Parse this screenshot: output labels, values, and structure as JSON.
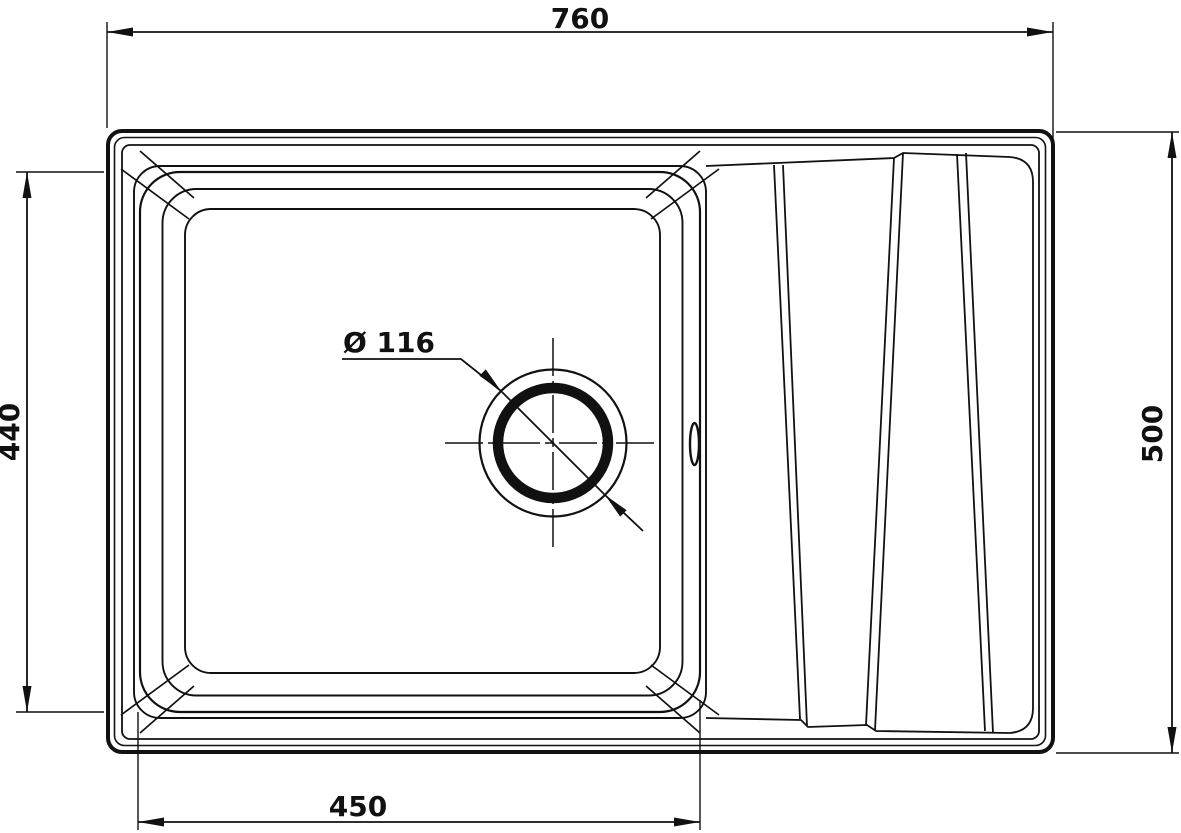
{
  "drawing": {
    "type": "technical-dimension-drawing",
    "subject": "kitchen sink top view - single bowl with drainboard",
    "units": "mm",
    "line_color": "#111111",
    "background_color": "#ffffff",
    "dimensions": {
      "overall_width": {
        "label": "760",
        "value": 760,
        "edge": "top"
      },
      "overall_depth": {
        "label": "500",
        "value": 500,
        "edge": "right"
      },
      "bowl_depth": {
        "label": "440",
        "value": 440,
        "edge": "left"
      },
      "bowl_width": {
        "label": "450",
        "value": 450,
        "edge": "bottom"
      },
      "drain_diameter": {
        "label": "Ø 116",
        "value": 116,
        "edge": "bowl-center-callout"
      }
    },
    "features": [
      "outer body rounded rectangle with double rim line",
      "square bowl with three stepped rims and chamfered corners",
      "drain hole with crosshair centerlines and diameter callout",
      "overflow slot on right bowl wall",
      "drainboard with three slanted groove pairs",
      "dimension lines with solid arrowheads and extension lines"
    ]
  }
}
